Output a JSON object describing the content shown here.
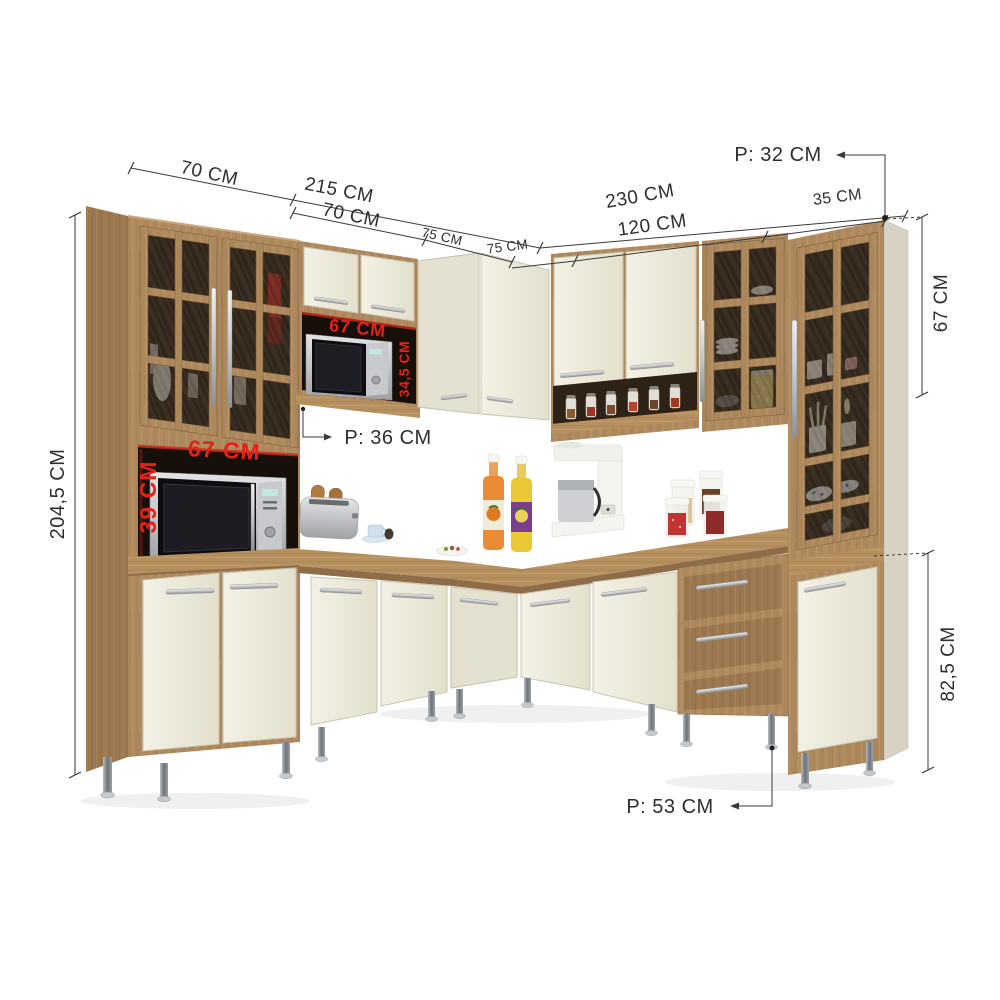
{
  "labels": {
    "left_wall_depth": "70 CM",
    "left_wall_width": "215 CM",
    "left_cabinet_width": "70 CM",
    "mid_cabinet_width": "75 CM",
    "corner_right_width": "75 CM",
    "right_wall_width": "230 CM",
    "right_cabinet_width": "120 CM",
    "end_cabinet_width": "35 CM",
    "top_depth": "P: 32 CM",
    "total_height": "204,5 CM",
    "upper_right_height": "67 CM",
    "base_height": "82,5 CM",
    "mid_depth": "P: 36 CM",
    "base_depth": "P: 53 CM",
    "niche_lower_width": "67 CM",
    "niche_lower_height": "39 CM",
    "niche_upper_width": "67 CM",
    "niche_upper_height": "34,5 CM"
  },
  "colors": {
    "background": "#ffffff",
    "wood": "#b08a5f",
    "wood_dark": "#9c7850",
    "wood_light": "#c29b6e",
    "counter_wood": "#b6905f",
    "cream_door": "#eeecdf",
    "glass": "#33271c",
    "niche": "#170f09",
    "dimension_line": "#3a3a3a",
    "red_label": "#e2231a",
    "metal": "#c9cbce",
    "leg": "#878c90"
  }
}
